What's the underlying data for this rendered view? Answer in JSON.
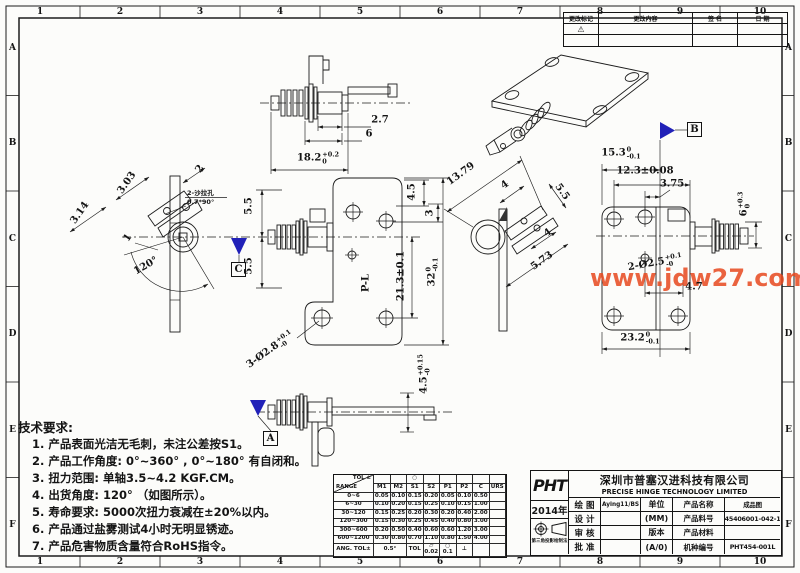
{
  "frame": {
    "top_numbers": [
      "1",
      "2",
      "3",
      "4",
      "5",
      "6",
      "7",
      "8",
      "9",
      "10"
    ],
    "bottom_numbers": [
      "1",
      "2",
      "3",
      "4",
      "5",
      "6",
      "7",
      "8",
      "9",
      "10"
    ],
    "left_letters": [
      "A",
      "B",
      "C",
      "D",
      "E",
      "F"
    ],
    "right_letters": [
      "A",
      "B",
      "C",
      "D",
      "E",
      "F"
    ]
  },
  "revision_table": {
    "headers": [
      "更改标记",
      "更改内容",
      "签  名",
      "日  期"
    ],
    "mark": "⚠"
  },
  "watermark": {
    "text": "www.jdw27.com",
    "color": "#e8491f"
  },
  "datum_labels": {
    "a": "A",
    "b": "B",
    "c": "C"
  },
  "view_labels": {
    "pl": "P-L"
  },
  "dims": {
    "v1_a": "2.7",
    "v1_b": "6",
    "v1_c": {
      "main": "18.2",
      "sup": "+0.2",
      "sub": "0"
    },
    "v2_a": "3.03",
    "v2_b": "3.14",
    "v2_c": "2",
    "v2_d": "1",
    "v2_angle": "120°",
    "v2_note1": "2-沙拉孔",
    "v2_note2": "0.7*90°",
    "v3_a": "5.5",
    "v3_b": "5.5",
    "v3_c": "4.5",
    "v3_d": "3",
    "v3_e": "21.3±0.1",
    "v3_f": {
      "main": "32",
      "sup": "0",
      "sub": "-0.1"
    },
    "v3_g": {
      "main": "3-Ø2.8",
      "sup": "+0.1",
      "sub": "-0"
    },
    "v4_a": "13.79",
    "v4_b": "4",
    "v4_c": "5.5",
    "v4_d": "4",
    "v4_e": "5.73",
    "v5_a": {
      "main": "15.3",
      "sup": "0",
      "sub": "-0.1"
    },
    "v5_b": "12.3±0.08",
    "v5_c": "3.75",
    "v5_d": {
      "main": "6",
      "sup": "+0.3",
      "sub": "0"
    },
    "v5_e": {
      "main": "2-Ø2.5",
      "sup": "+0.1",
      "sub": "-0"
    },
    "v5_f": "4.7",
    "v5_g": {
      "main": "23.2",
      "sup": "0",
      "sub": "-0.1"
    },
    "v7_a": {
      "main": "4.5",
      "sup": "+0.15",
      "sub": "-0"
    }
  },
  "tech_requirements": {
    "title": "技术要求:",
    "items": [
      "1. 产品表面光洁无毛刺，未注公差按S1。",
      "2. 产品工作角度: 0°~360° , 0°~180° 有自闭和。",
      "3. 扭力范围: 单轴3.5~4.2 KGF.CM。",
      "4. 出货角度: 120° （如图所示）。",
      "5. 寿命要求: 5000次扭力衰减在±20%以内。",
      "6. 产品通过盐雾测试4小时无明显锈迹。",
      "7. 产品危害物质含量符合RoHS指令。"
    ]
  },
  "tolerance_table": {
    "corner_top": "TOL ±",
    "corner_bottom": "RANGE",
    "header_symbol": "○",
    "columns": [
      "M1",
      "M2",
      "S1",
      "S2",
      "P1",
      "P2",
      "C",
      "URS"
    ],
    "rows": [
      {
        "range": "0~6",
        "values": [
          "0.05",
          "0.10",
          "0.15",
          "0.20",
          "0.05",
          "0.10",
          "0.50",
          ""
        ]
      },
      {
        "range": "6~30",
        "values": [
          "0.10",
          "0.20",
          "0.15",
          "0.25",
          "0.10",
          "0.15",
          "1.00",
          ""
        ]
      },
      {
        "range": "30~120",
        "values": [
          "0.15",
          "0.25",
          "0.20",
          "0.30",
          "0.20",
          "0.40",
          "2.00",
          ""
        ]
      },
      {
        "range": "120~300",
        "values": [
          "0.15",
          "0.30",
          "0.25",
          "0.45",
          "0.40",
          "0.80",
          "3.00",
          ""
        ]
      },
      {
        "range": "300~600",
        "values": [
          "0.20",
          "0.50",
          "0.40",
          "0.60",
          "0.60",
          "1.20",
          "3.00",
          ""
        ]
      },
      {
        "range": "600~1200",
        "values": [
          "0.30",
          "0.80",
          "0.70",
          "1.10",
          "0.80",
          "1.50",
          "4.00",
          ""
        ]
      }
    ],
    "ang_label": "ANG. TOL±",
    "ang_value": "0.5°",
    "geo_label": "TOL",
    "flatness_symbol": "▱",
    "flatness_value": "0.02",
    "circularity_symbol": "○",
    "circularity_value": "0.1",
    "perpendicularity_symbol": "⊥"
  },
  "title_block": {
    "logo": "PHT",
    "year": "2014年",
    "projection_note": "第三角投影绘制法",
    "company_cn": "深圳市普塞汉进科技有限公司",
    "company_en": "PRECISE HINGE TECHNOLOGY LIMITED",
    "rows": [
      {
        "label": "绘  图",
        "value": "Aying11/BS",
        "mid": "单位",
        "field": "产品名称",
        "data": "成品图"
      },
      {
        "label": "设  计",
        "value": "",
        "mid": "(MM)",
        "field": "产品料号",
        "data": "145406001-042-10"
      },
      {
        "label": "审  核",
        "value": "",
        "mid": "版本",
        "field": "产品材料",
        "data": ""
      },
      {
        "label": "批  准",
        "value": "",
        "mid": "(A/0)",
        "field": "机种编号",
        "data": "PHT454-001L"
      }
    ]
  }
}
